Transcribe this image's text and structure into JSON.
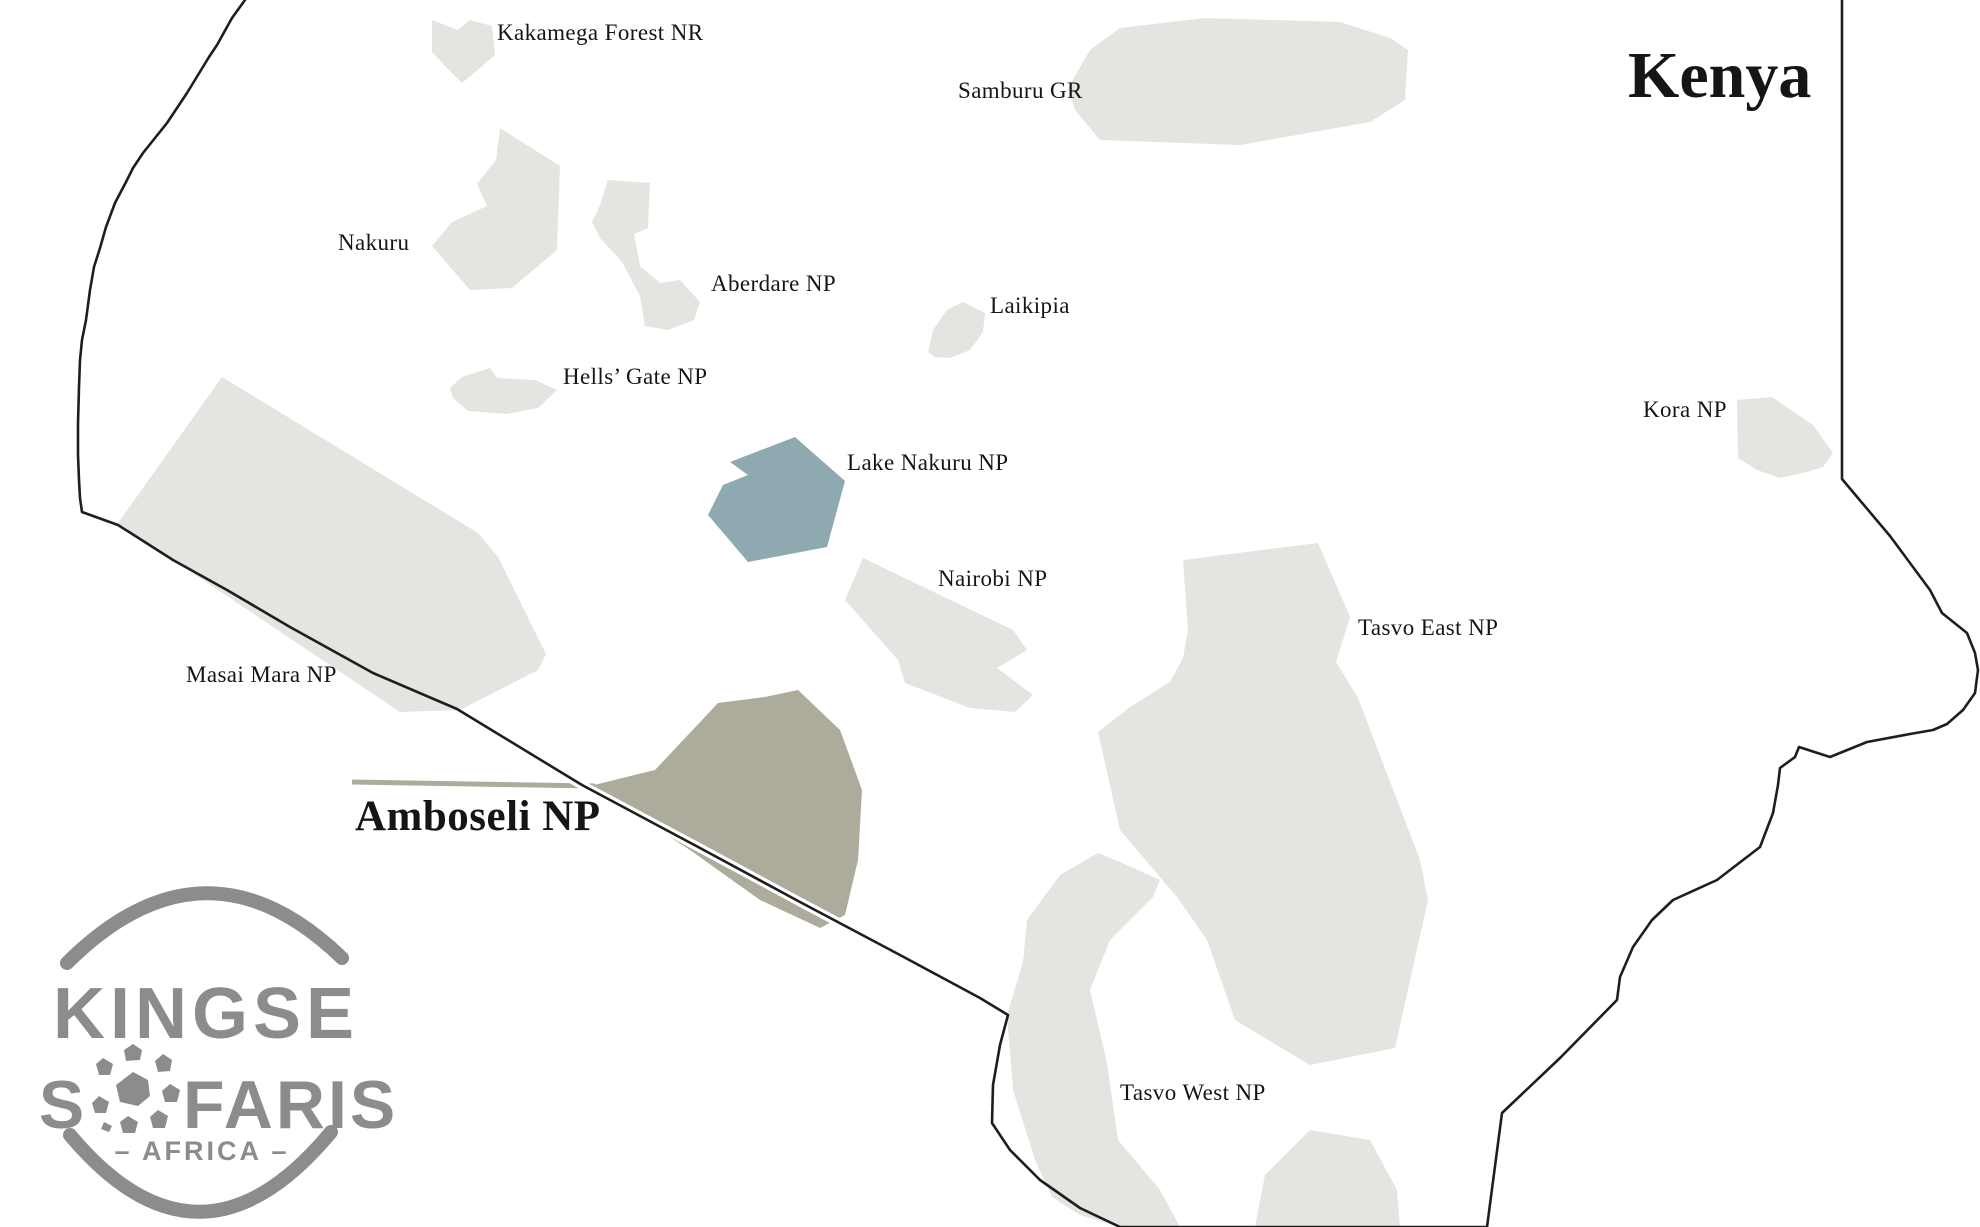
{
  "map": {
    "country": "Kenya",
    "labels": {
      "kakamega": "Kakamega Forest NR",
      "samburu": "Samburu GR",
      "nakuru": "Nakuru",
      "aberdare": "Aberdare NP",
      "laikipia": "Laikipia",
      "hells_gate": "Hells’ Gate NP",
      "lake_nakuru": "Lake Nakuru NP",
      "nairobi": "Nairobi NP",
      "kora": "Kora NP",
      "masai_mara": "Masai Mara NP",
      "tsavo_east": "Tasvo East NP",
      "amboseli": "Amboseli NP",
      "tsavo_west": "Tasvo West NP"
    },
    "colors": {
      "background": "#ffffff",
      "park_fill": "#e5e4e0",
      "highlight_blue": "#8fa9b0",
      "highlight_olive": "#adab9b",
      "border": "#1e1e1e",
      "label": "#151515",
      "logo_gray": "#8c8c8c"
    }
  },
  "logo": {
    "line1": "KINGSE",
    "line2_left": "S",
    "line2_right": "FARIS",
    "line3": "– AFRICA –"
  }
}
